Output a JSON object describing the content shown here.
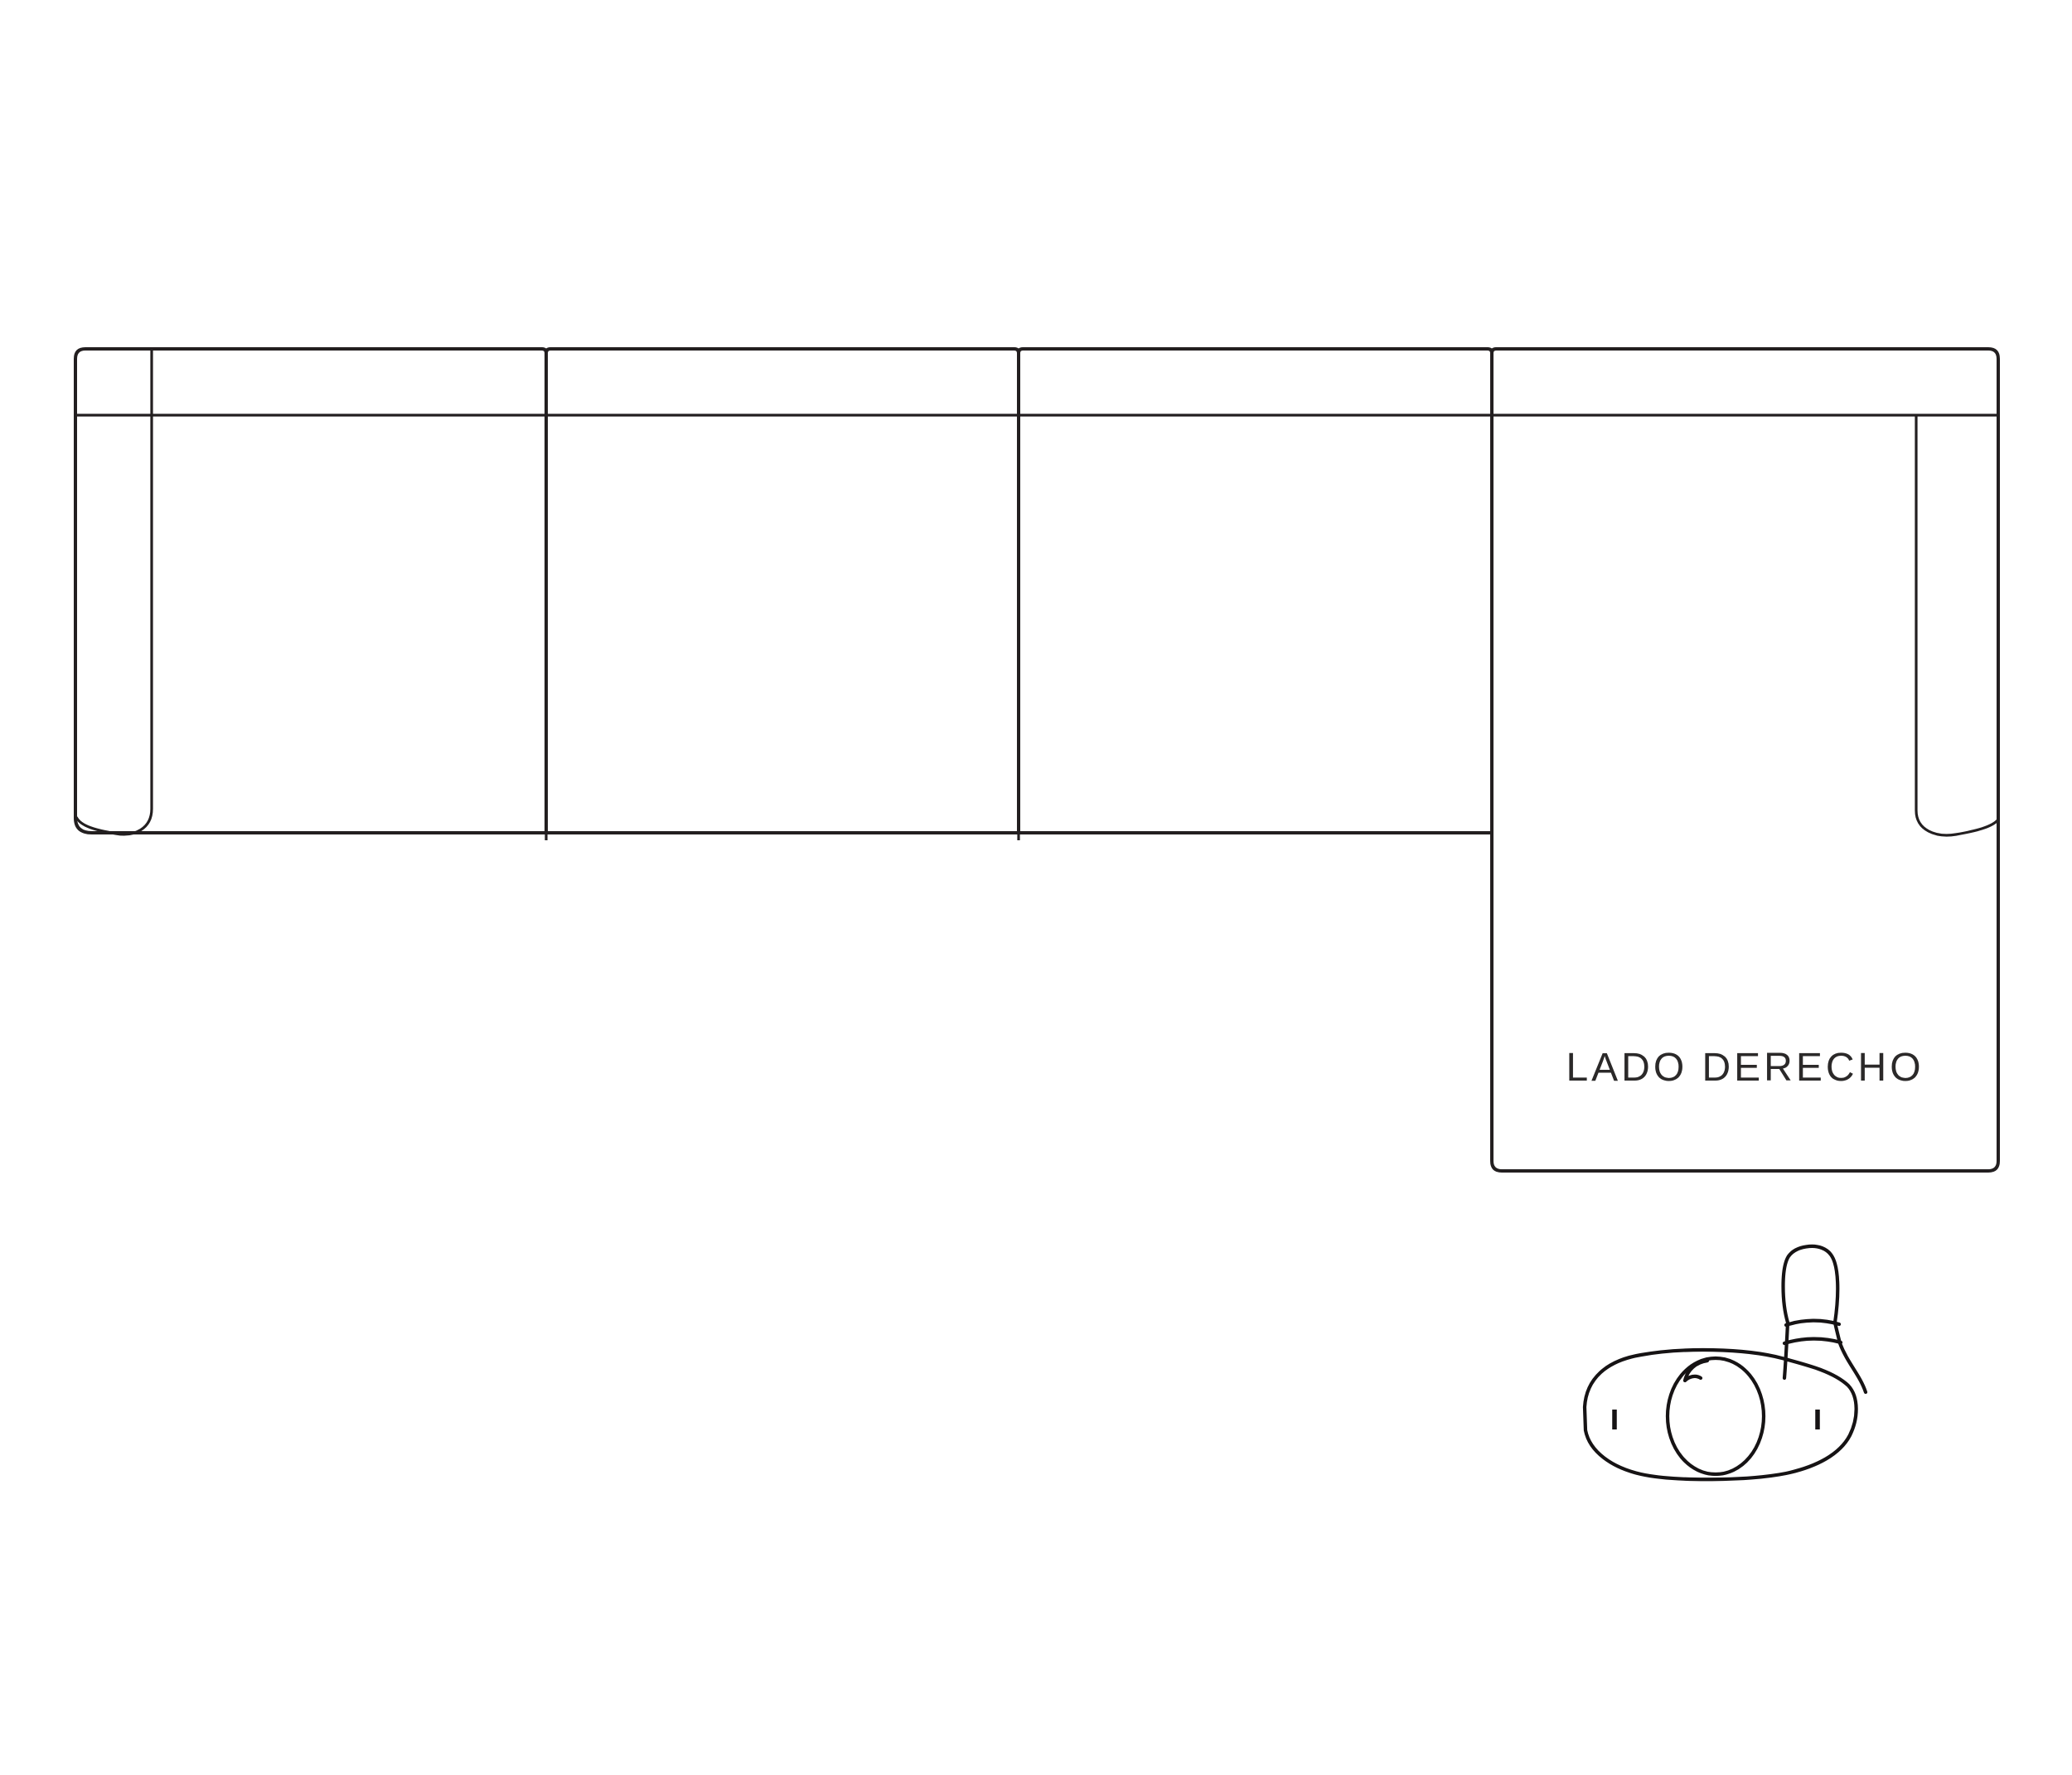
{
  "diagram": {
    "chaise_label": "LADO DERECHO"
  },
  "icons": {
    "sofa": "sectional-sofa-top-view",
    "person": "person-top-view"
  },
  "colors": {
    "background": "#ffffff",
    "sofa-line": "#231f20",
    "figure-line": "#161314",
    "label-text": "#2b2929"
  }
}
